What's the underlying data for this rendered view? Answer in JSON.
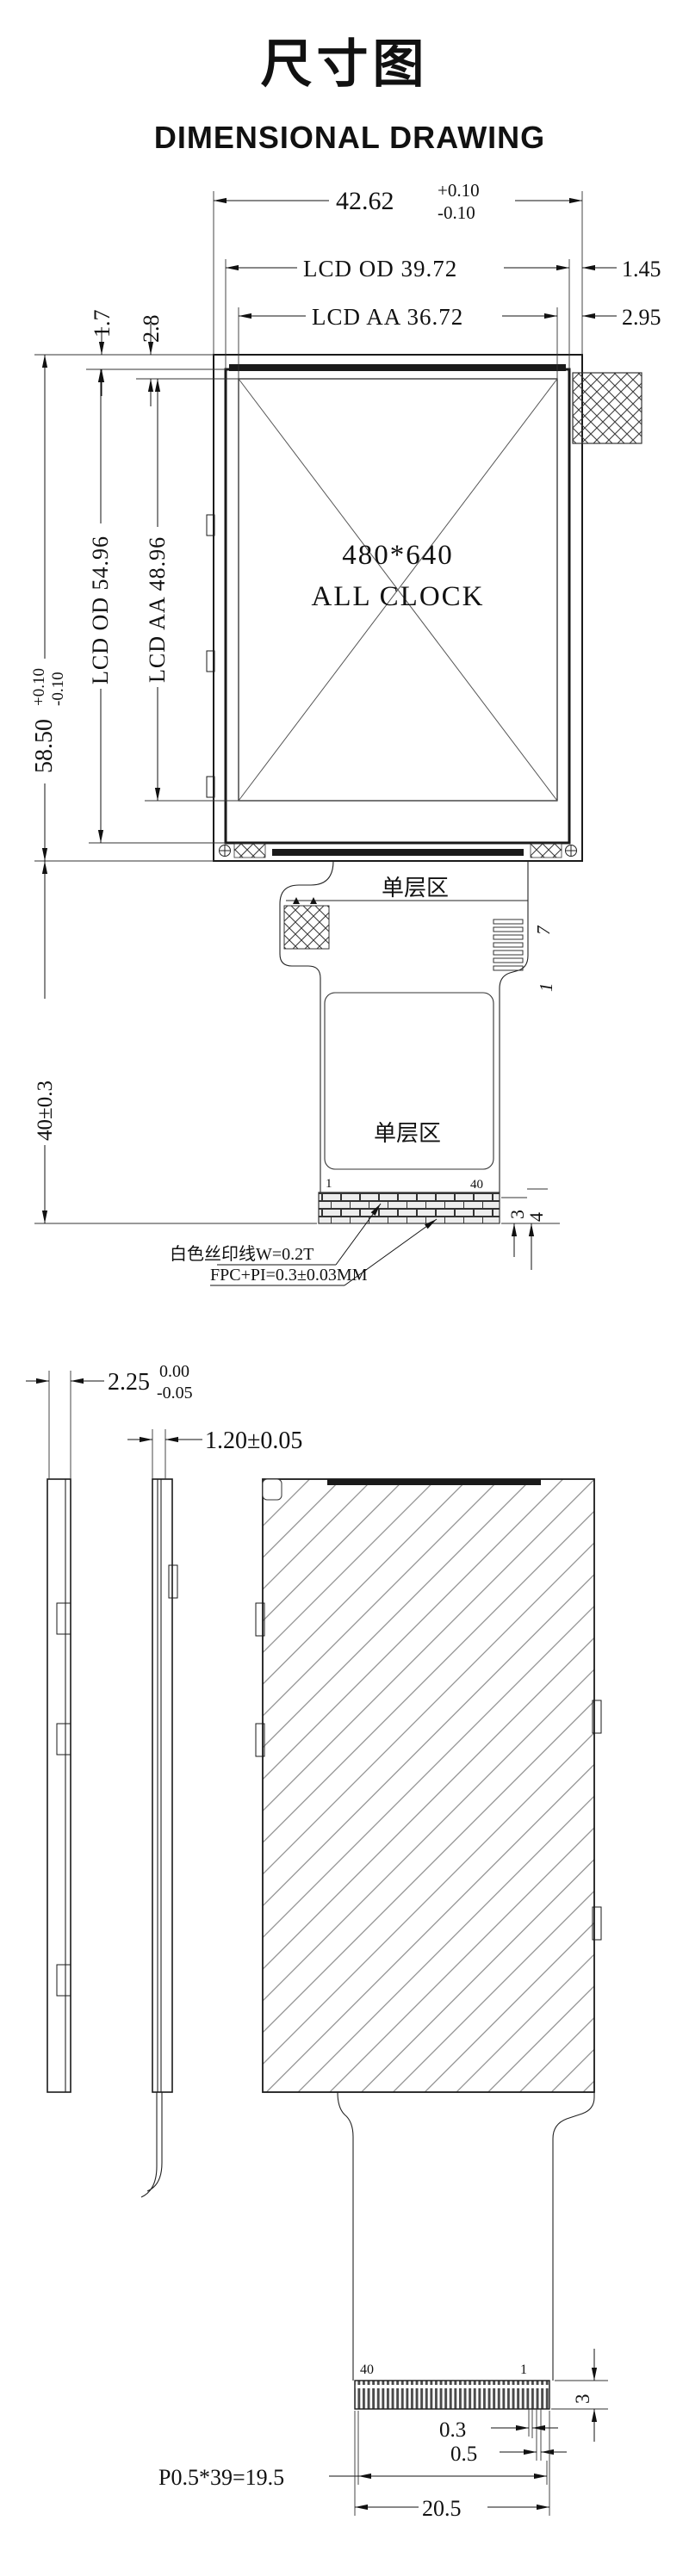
{
  "page": {
    "title": "尺寸图",
    "subtitle": "DIMENSIONAL DRAWING"
  },
  "front_view": {
    "dims": {
      "overall_width": "42.62",
      "overall_width_tol_plus": "+0.10",
      "overall_width_tol_minus": "-0.10",
      "lcd_od_width": "LCD OD 39.72",
      "od_side_margin": "1.45",
      "lcd_aa_width": "LCD AA 36.72",
      "aa_side_margin": "2.95",
      "od_top_margin": "1.7",
      "aa_top_margin": "2.8",
      "overall_height": "58.50",
      "overall_height_tol_plus": "+0.10",
      "overall_height_tol_minus": "-0.10",
      "lcd_od_height": "LCD OD 54.96",
      "lcd_aa_height": "LCD AA 48.96",
      "fpc_length": "40±0.3",
      "stiffener_dim_3": "3",
      "stiffener_dim_4": "4"
    },
    "labels": {
      "resolution": "480*640",
      "product": "ALL CLOCK",
      "single_layer_upper": "单层区",
      "single_layer_lower": "单层区",
      "pin_last": "7",
      "pin_first": "1",
      "pad_first": "1",
      "pad_last": "40",
      "callout_silkscreen": "白色丝印线W=0.2T",
      "callout_fpc": "FPC+PI=0.3±0.03MM"
    }
  },
  "side_view": {
    "dims": {
      "total_thickness": "2.25",
      "total_thickness_tol_plus": "0.00",
      "total_thickness_tol_minus": "-0.05",
      "panel_thickness": "1.20±0.05"
    }
  },
  "back_view": {
    "labels": {
      "pad_last": "40",
      "pad_first": "1"
    },
    "dims": {
      "connector_height": "3",
      "pad_width": "0.3",
      "pad_pitch": "0.5",
      "pitch_total": "P0.5*39=19.5",
      "connector_width": "20.5"
    }
  }
}
